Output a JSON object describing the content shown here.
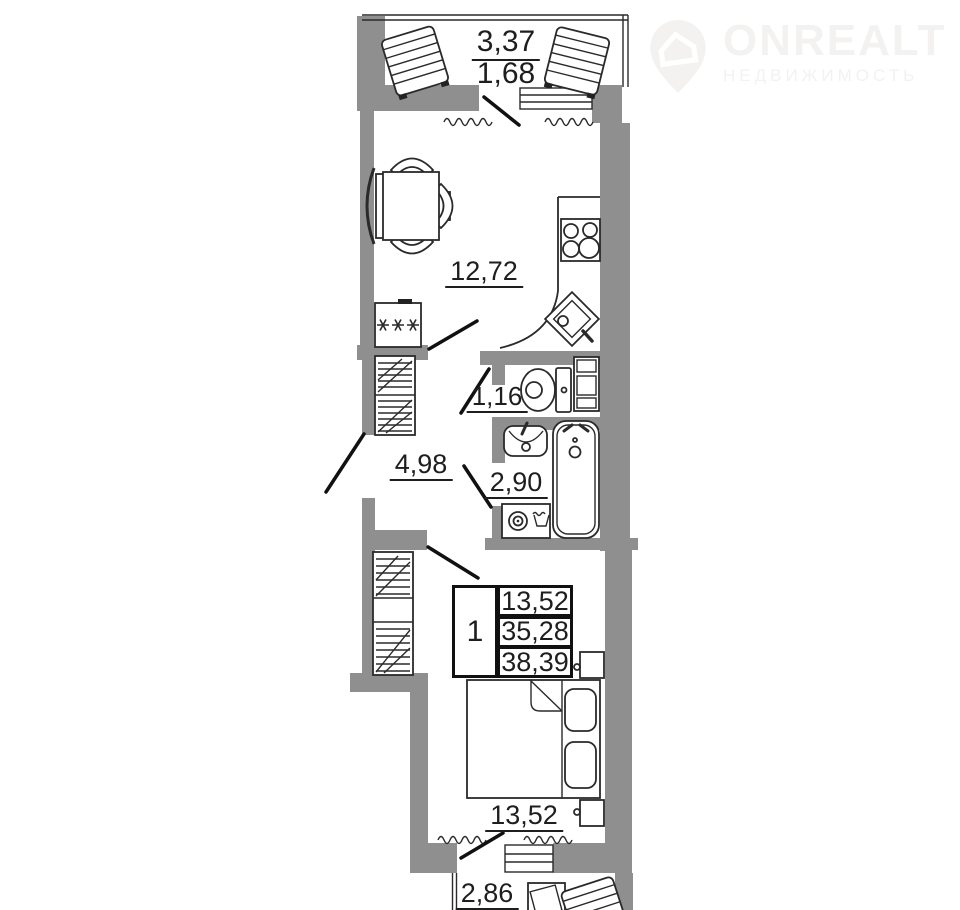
{
  "watermark": {
    "brand": "ONREALT",
    "subtitle": "НЕДВИЖИМОСТЬ"
  },
  "rooms": {
    "balcony_top": {
      "area_total": "3,37",
      "area_reduced": "1,68"
    },
    "kitchen": {
      "area": "12,72"
    },
    "wc": {
      "area": "1,16"
    },
    "hallway": {
      "area": "4,98"
    },
    "bathroom": {
      "area": "2,90"
    },
    "bedroom": {
      "area": "13,52"
    },
    "balcony_bottom": {
      "area": "2,86"
    }
  },
  "info_table": {
    "rooms_count": "1",
    "rows": [
      "13,52",
      "35,28",
      "38,39"
    ]
  },
  "colors": {
    "wall": "#8f8f8f",
    "line": "#2a2a2a",
    "text": "#1e1e1e",
    "watermark": "#f3f2f0"
  }
}
